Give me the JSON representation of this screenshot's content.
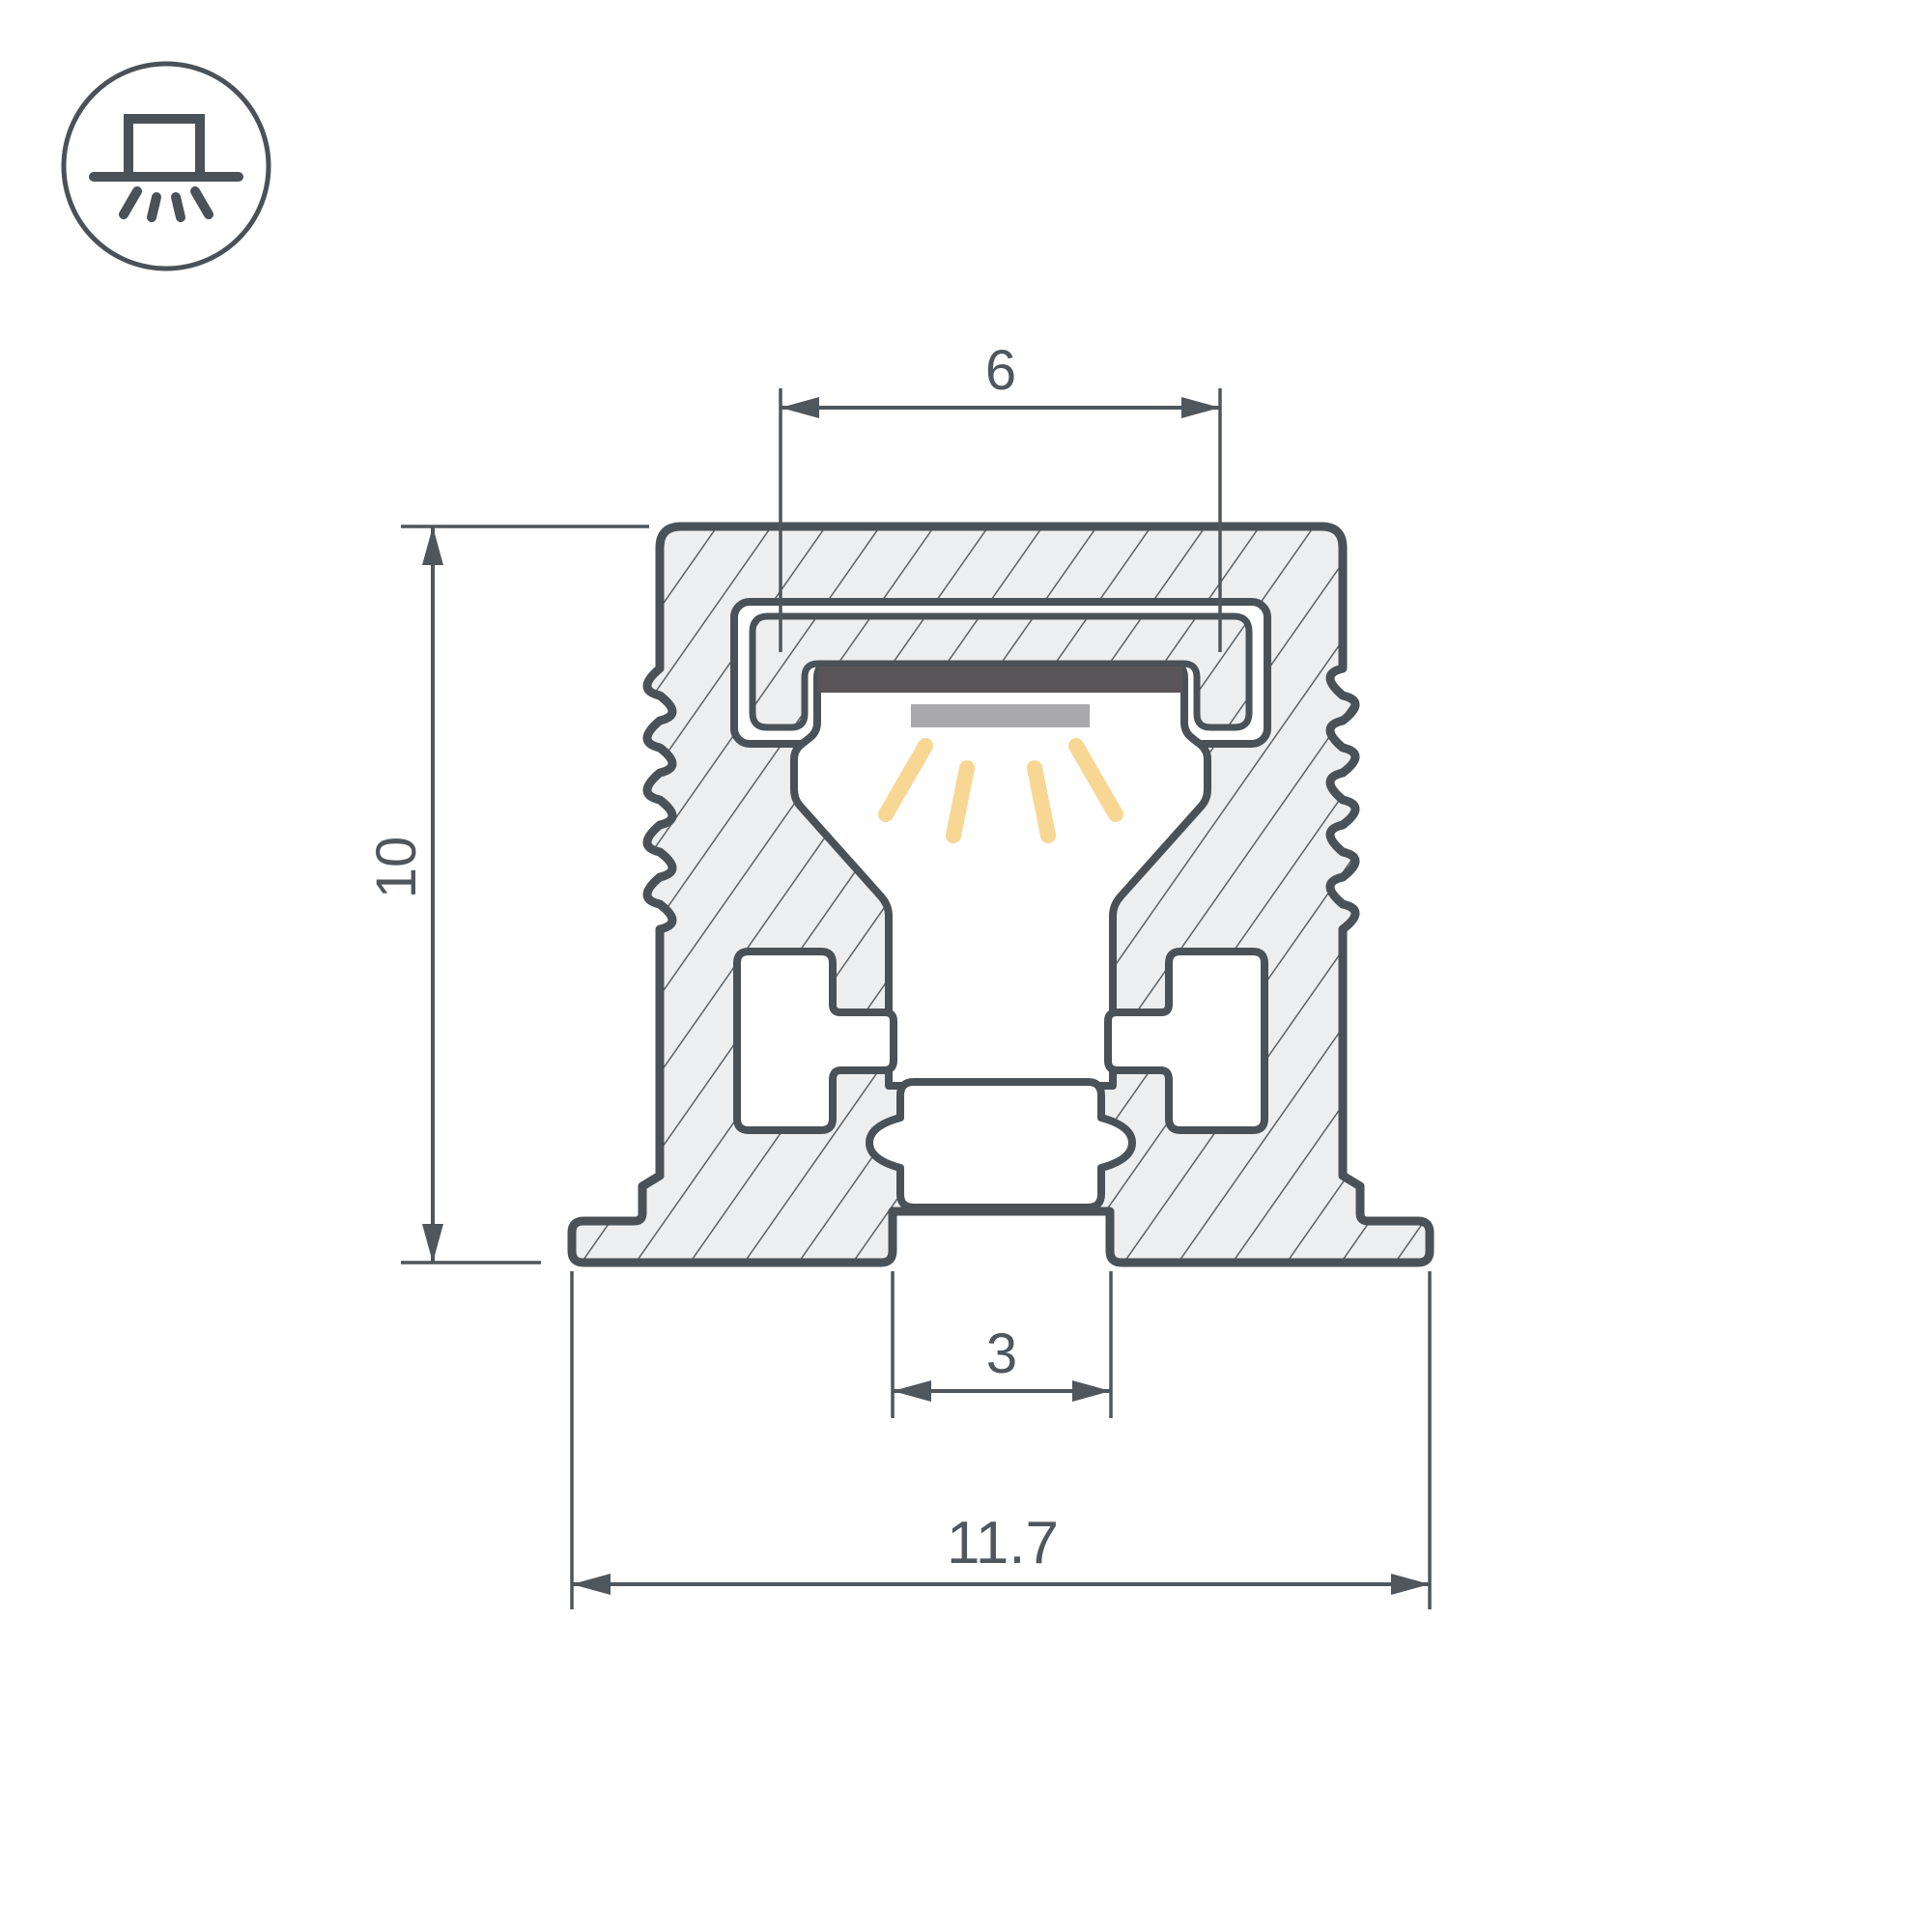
{
  "drawing": {
    "title_icon": "surface-mounted-downlight",
    "dimensions": {
      "top_opening_width": {
        "label": "6"
      },
      "profile_height": {
        "label": "10"
      },
      "bottom_slot_width": {
        "label": "3"
      },
      "overall_width": {
        "label": "11.7"
      }
    },
    "colors": {
      "background": "#FFFFFF",
      "outline": "#4A5157",
      "hatch_fill": "#EDEEEF",
      "hatch_line": "#5A6167",
      "dimension": "#4F565C",
      "diffuser_dark": "#595558",
      "led_bar_gray": "#A9A9AB",
      "light_rays": "#F8D794"
    }
  }
}
